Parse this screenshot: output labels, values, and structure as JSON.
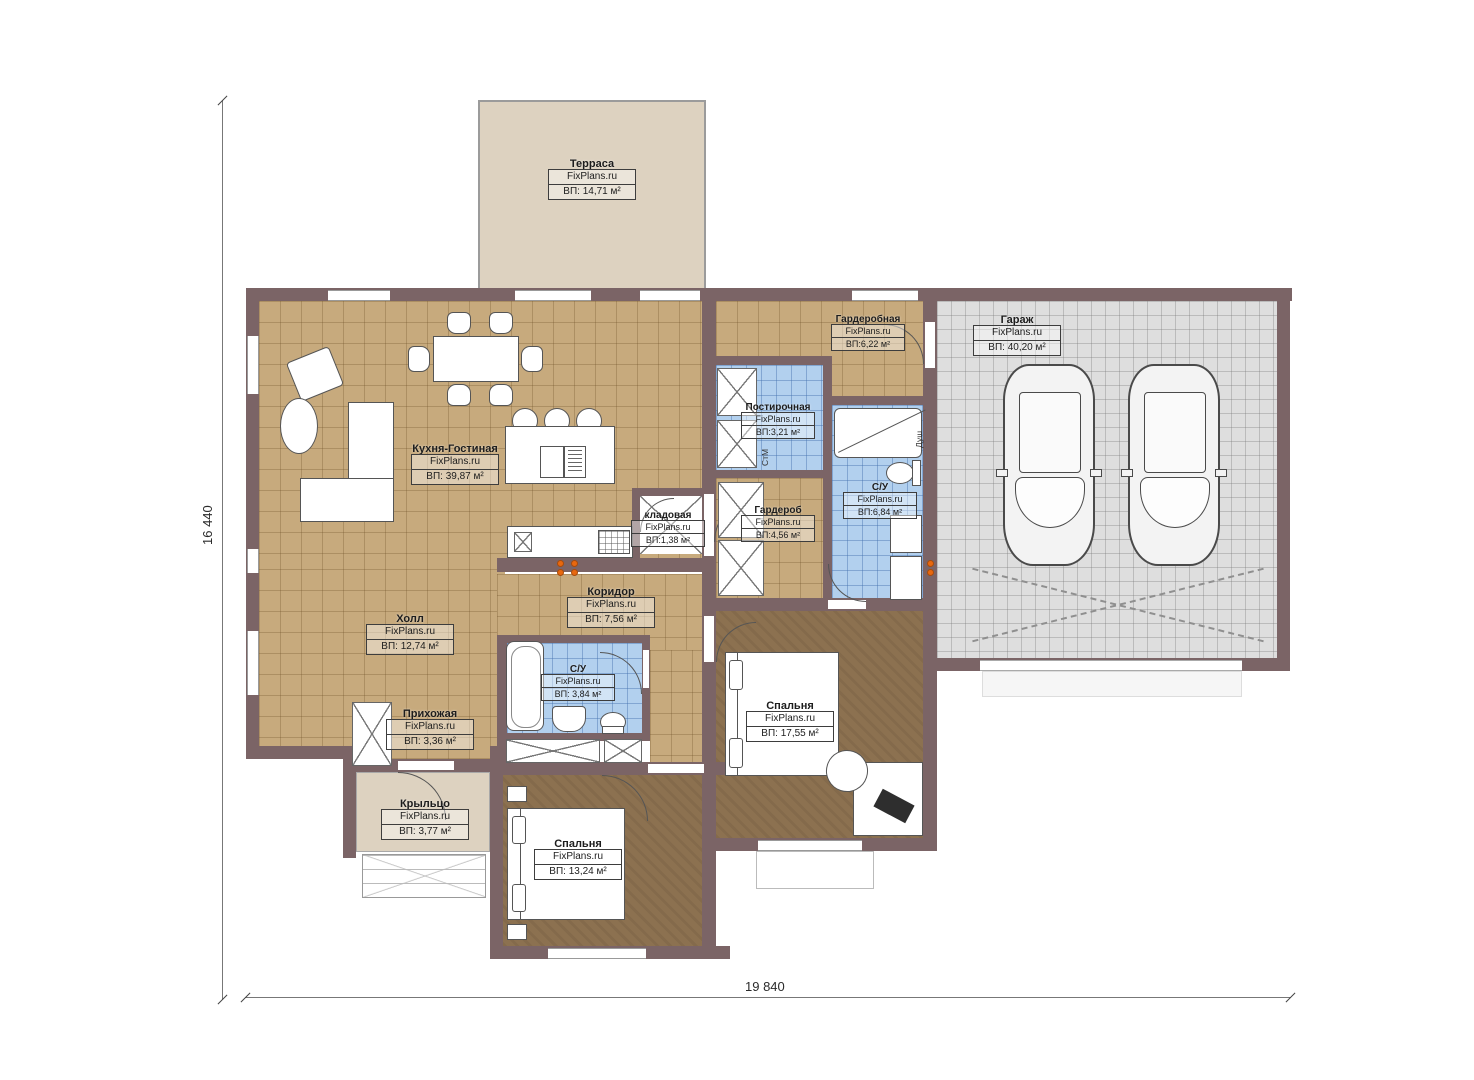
{
  "site": {
    "brand": "FixPlans.ru"
  },
  "dimensions": {
    "width_label": "19 840",
    "height_label": "16 440"
  },
  "rooms": [
    {
      "id": "terrace",
      "name": "Терраса",
      "area": "ВП: 14,71 м²"
    },
    {
      "id": "kitchen-living",
      "name": "Кухня-Гостиная",
      "area": "ВП: 39,87 м²"
    },
    {
      "id": "walkin-closet",
      "name": "Гардеробная",
      "area": "ВП:6,22 м²"
    },
    {
      "id": "garage",
      "name": "Гараж",
      "area": "ВП: 40,20 м²"
    },
    {
      "id": "laundry",
      "name": "Постирочная",
      "area": "ВП:3,21 м²"
    },
    {
      "id": "bathroom-main",
      "name": "С/У",
      "area": "ВП:6,84 м²"
    },
    {
      "id": "wardrobe",
      "name": "Гардероб",
      "area": "ВП:4,56 м²"
    },
    {
      "id": "pantry",
      "name": "кладовая",
      "area": "ВП:1,38 м²"
    },
    {
      "id": "corridor",
      "name": "Коридор",
      "area": "ВП: 7,56 м²"
    },
    {
      "id": "hall",
      "name": "Холл",
      "area": "ВП: 12,74 м²"
    },
    {
      "id": "bathroom-small",
      "name": "С/У",
      "area": "ВП: 3,84 м²"
    },
    {
      "id": "entry",
      "name": "Прихожая",
      "area": "ВП: 3,36 м²"
    },
    {
      "id": "bedroom-right",
      "name": "Спальня",
      "area": "ВП: 17,55 м²"
    },
    {
      "id": "porch",
      "name": "Крыльцо",
      "area": "ВП: 3,77 м²"
    },
    {
      "id": "bedroom-bottom",
      "name": "Спальня",
      "area": "ВП: 13,24 м²"
    }
  ],
  "annotations": {
    "washing_machine": "СтМ",
    "shower": "Душ"
  },
  "colors": {
    "wall": "#7b6466",
    "floor_tile_tan": "#c7aa7d",
    "floor_wood_brown": "#8c7150",
    "tile_blue": "#b2d0ee",
    "tile_gray": "#dedede",
    "terrace_beige": "#ddd2c0",
    "accent_orange": "#e8680f",
    "line": "#555555"
  }
}
